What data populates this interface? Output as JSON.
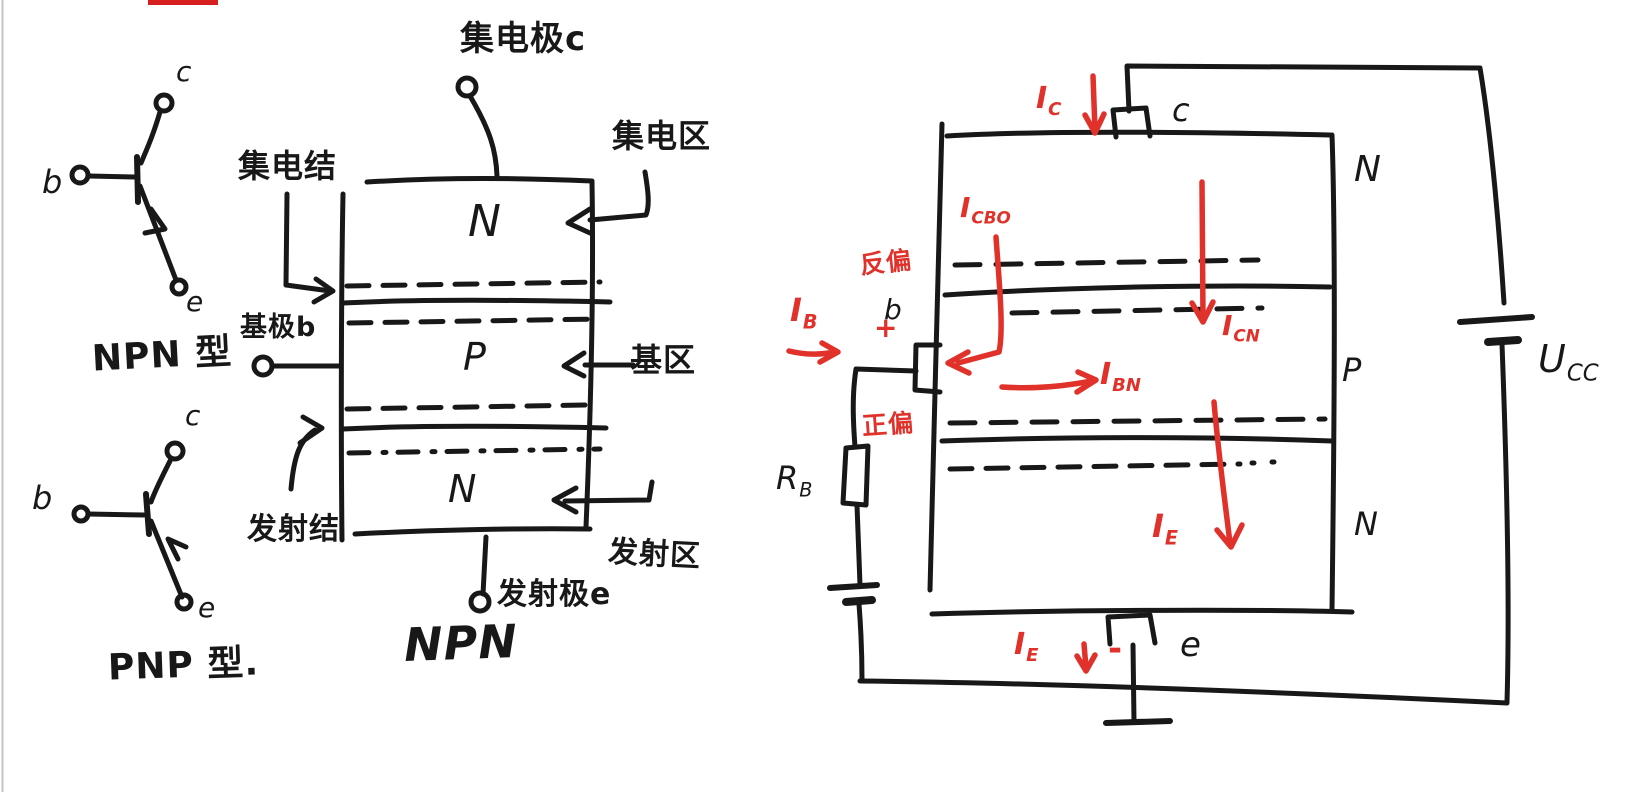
{
  "canvas": {
    "background": "#ffffff",
    "ink_color": "#181818",
    "red_color": "#e0322a",
    "page_edge_color": "#c4c4c4"
  },
  "left_panel": {
    "npn_symbol": {
      "c": "c",
      "b": "b",
      "e": "e",
      "type_label": "NPN 型"
    },
    "pnp_symbol": {
      "c": "c",
      "b": "b",
      "e": "e",
      "type_label": "PNP 型."
    }
  },
  "structure_diagram": {
    "collector_terminal_label": "集电极c",
    "collector_region_label": "集电区",
    "collector_junction_label": "集电结",
    "base_terminal_label": "基极b",
    "base_region_label": "基区",
    "emitter_junction_label": "发射结",
    "emitter_region_label": "发射区",
    "emitter_terminal_label": "发射极e",
    "regions": {
      "top": "N",
      "middle": "P",
      "bottom": "N"
    },
    "caption": "NPN"
  },
  "circuit_diagram": {
    "terminals": {
      "c": "c",
      "b": "b",
      "e": "e"
    },
    "regions": {
      "top": "N",
      "middle": "P",
      "bottom": "N"
    },
    "bias": {
      "reverse": "反偏",
      "forward": "正偏",
      "plus": "+",
      "minus": "-"
    },
    "currents": {
      "ic": {
        "base": "I",
        "sub": "C"
      },
      "icbo": {
        "base": "I",
        "sub": "CBO"
      },
      "icn": {
        "base": "I",
        "sub": "CN"
      },
      "ib": {
        "base": "I",
        "sub": "B"
      },
      "ibn": {
        "base": "I",
        "sub": "BN"
      },
      "ie_inner": {
        "base": "I",
        "sub": "E"
      },
      "ie_bottom": {
        "base": "I",
        "sub": "E"
      }
    },
    "resistor": {
      "base": "R",
      "sub": "B"
    },
    "supply": {
      "base": "U",
      "sub": "CC"
    }
  }
}
